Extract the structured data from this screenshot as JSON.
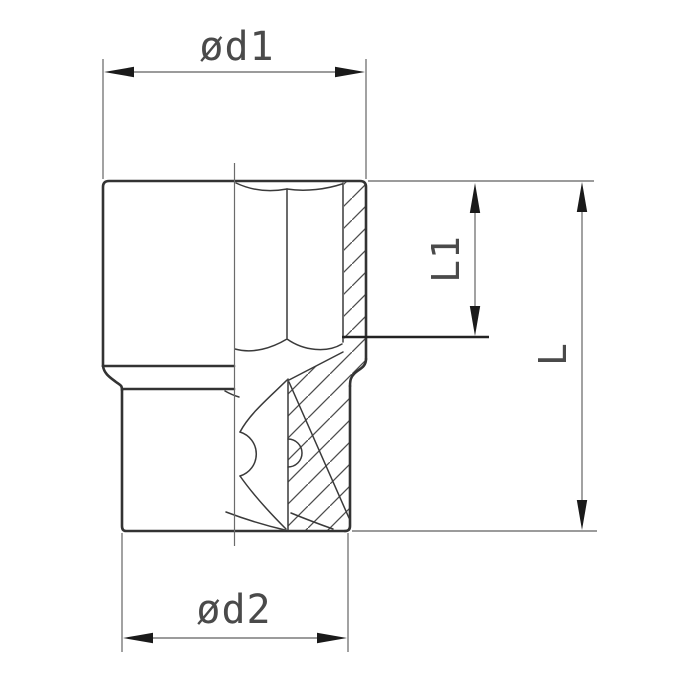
{
  "drawing": {
    "kind": "socket-cross-section-dimension-diagram",
    "labels": {
      "d1": "ød1",
      "d2": "ød2",
      "l1": "L1",
      "l": "L"
    },
    "colors": {
      "background": "#ffffff",
      "outline": "#333333",
      "inner_lines": "#3a3a3a",
      "dimension_lines": "#7a7a7a",
      "arrowheads": "#1a1a1a",
      "label_text": "#4a4a4a"
    }
  }
}
